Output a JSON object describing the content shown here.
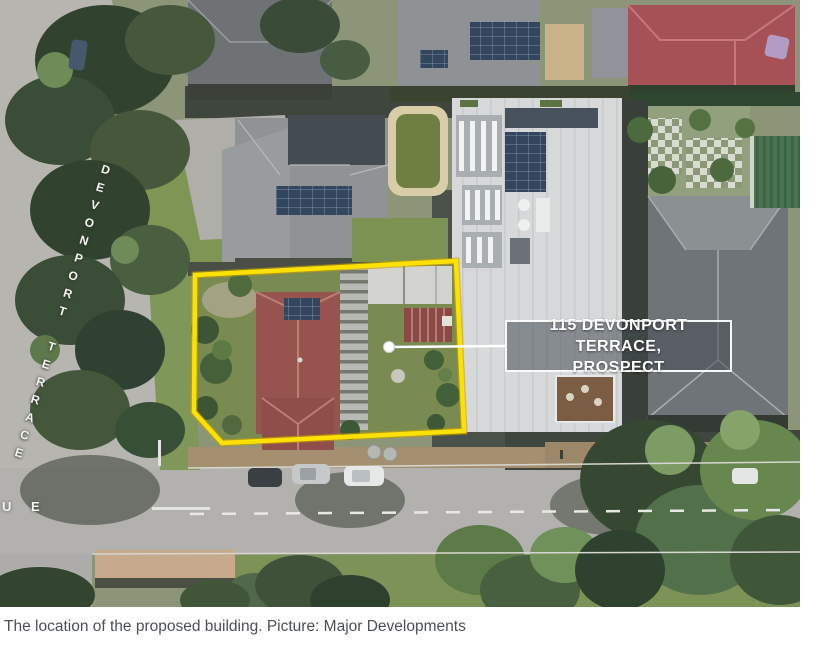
{
  "figure": {
    "type": "aerial-photo",
    "caption": "The location of the proposed building. Picture: Major Developments"
  },
  "map": {
    "street_label_vertical": "DEVONPORT TERRACE",
    "street_label_partial": "U E",
    "property_callout": {
      "line1": "115 DEVONPORT TERRACE,",
      "line2": "PROSPECT"
    },
    "colors": {
      "highlight_outline": "#FFE100",
      "callout_box_fill": "rgba(70,76,82,0.55)",
      "callout_border": "#FFFFFF",
      "callout_text": "#FFFFFF",
      "caption_text": "#4C5055"
    }
  }
}
